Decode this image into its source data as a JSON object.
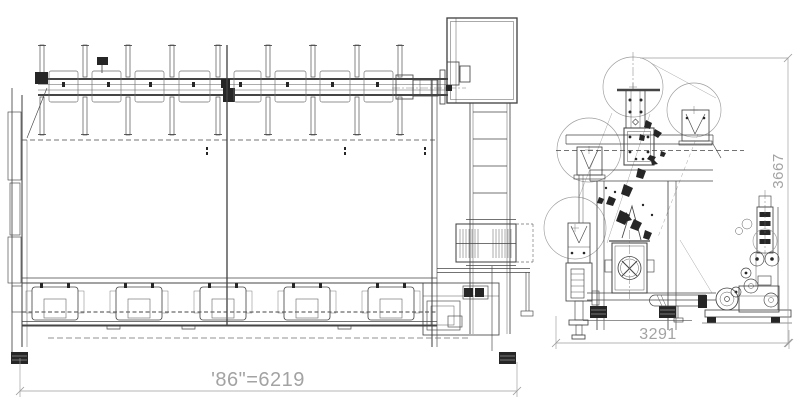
{
  "drawing": {
    "background_color": "#ffffff",
    "line_color": "#454545",
    "dimension_color": "#a3a3a3",
    "side_view": {
      "width_dimension_label": "'86\"=6219"
    },
    "end_view": {
      "width_dimension_label": "3291",
      "height_dimension_label": "3667"
    }
  }
}
